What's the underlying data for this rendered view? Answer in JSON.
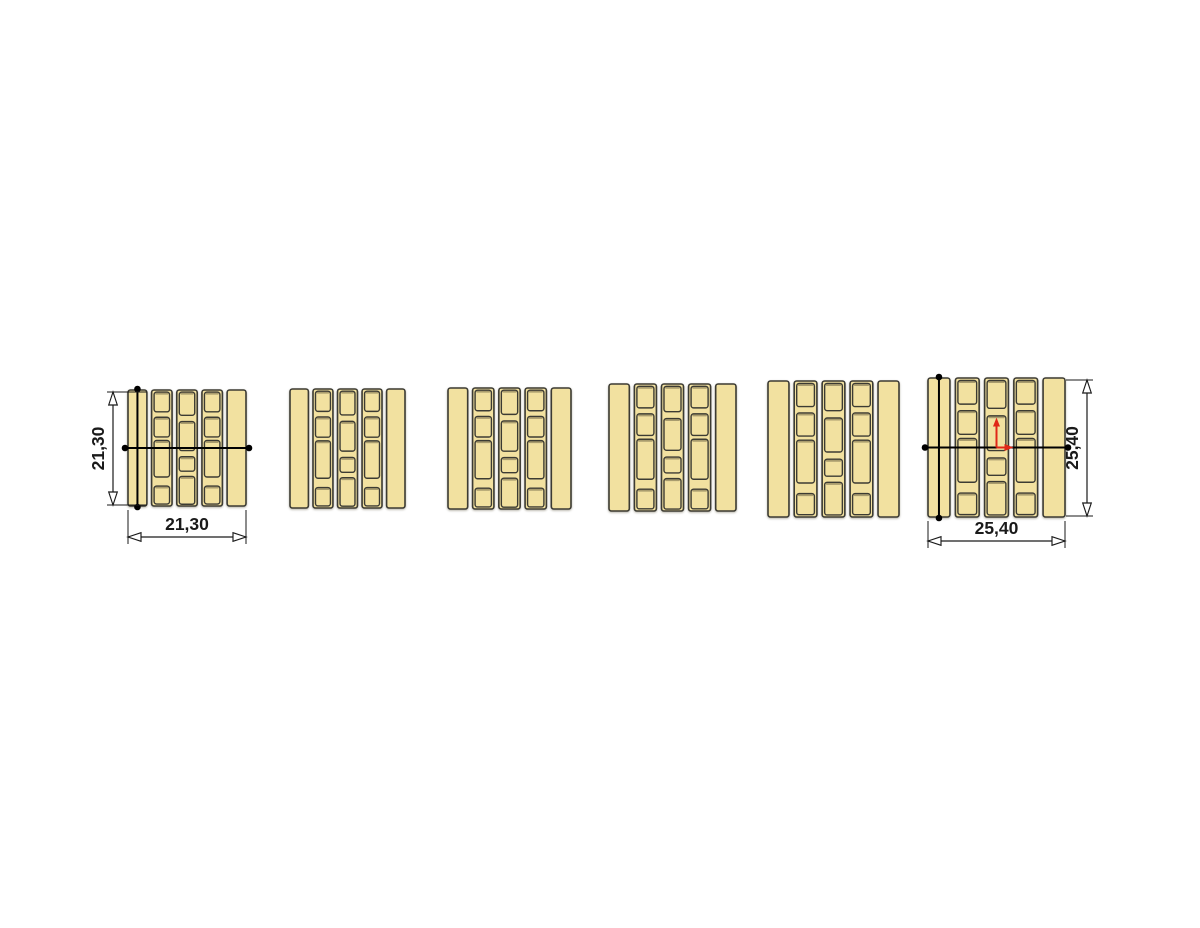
{
  "colors": {
    "background": "#FFFFFF",
    "block_fill": "#F2E1A0",
    "block_stroke": "#3C3B33",
    "dimension": "#1A1A1A",
    "section_line": "#000000",
    "axis_red": "#E02718"
  },
  "diagram": {
    "canvas": {
      "width": 1200,
      "height": 928
    },
    "pattern": {
      "bar_frac": 0.16,
      "gap_frac": 0.04,
      "core_inset": 2.5,
      "cores_side": [
        {
          "y": 0.018,
          "h": 0.17
        },
        {
          "y": 0.235,
          "h": 0.17
        },
        {
          "y": 0.435,
          "h": 0.315
        },
        {
          "y": 0.828,
          "h": 0.155
        }
      ],
      "cores_middle": [
        {
          "y": 0.018,
          "h": 0.2
        },
        {
          "y": 0.272,
          "h": 0.25
        },
        {
          "y": 0.575,
          "h": 0.125
        },
        {
          "y": 0.745,
          "h": 0.24
        }
      ]
    },
    "blocks": [
      {
        "name": "block-1",
        "x": 128,
        "y": 390,
        "w": 118,
        "h": 116,
        "section_lines": true,
        "origin_axes": false,
        "dims": {
          "height": {
            "label": "21,30",
            "side": "left",
            "offset": 15
          },
          "width": {
            "label": "21,30",
            "offset": 31
          }
        }
      },
      {
        "name": "block-2",
        "x": 290,
        "y": 389,
        "w": 115,
        "h": 119,
        "section_lines": false,
        "origin_axes": false,
        "dims": null
      },
      {
        "name": "block-3",
        "x": 448,
        "y": 388,
        "w": 123,
        "h": 121,
        "section_lines": false,
        "origin_axes": false,
        "dims": null
      },
      {
        "name": "block-4",
        "x": 609,
        "y": 384,
        "w": 127,
        "h": 127,
        "section_lines": false,
        "origin_axes": false,
        "dims": null
      },
      {
        "name": "block-5",
        "x": 768,
        "y": 381,
        "w": 131,
        "h": 136,
        "section_lines": false,
        "origin_axes": false,
        "dims": null
      },
      {
        "name": "block-6",
        "x": 928,
        "y": 378,
        "w": 137,
        "h": 139,
        "section_lines": true,
        "origin_axes": true,
        "dims": {
          "height": {
            "label": "25,40",
            "side": "right",
            "offset": 22
          },
          "width": {
            "label": "25,40",
            "offset": 24
          }
        }
      }
    ]
  }
}
